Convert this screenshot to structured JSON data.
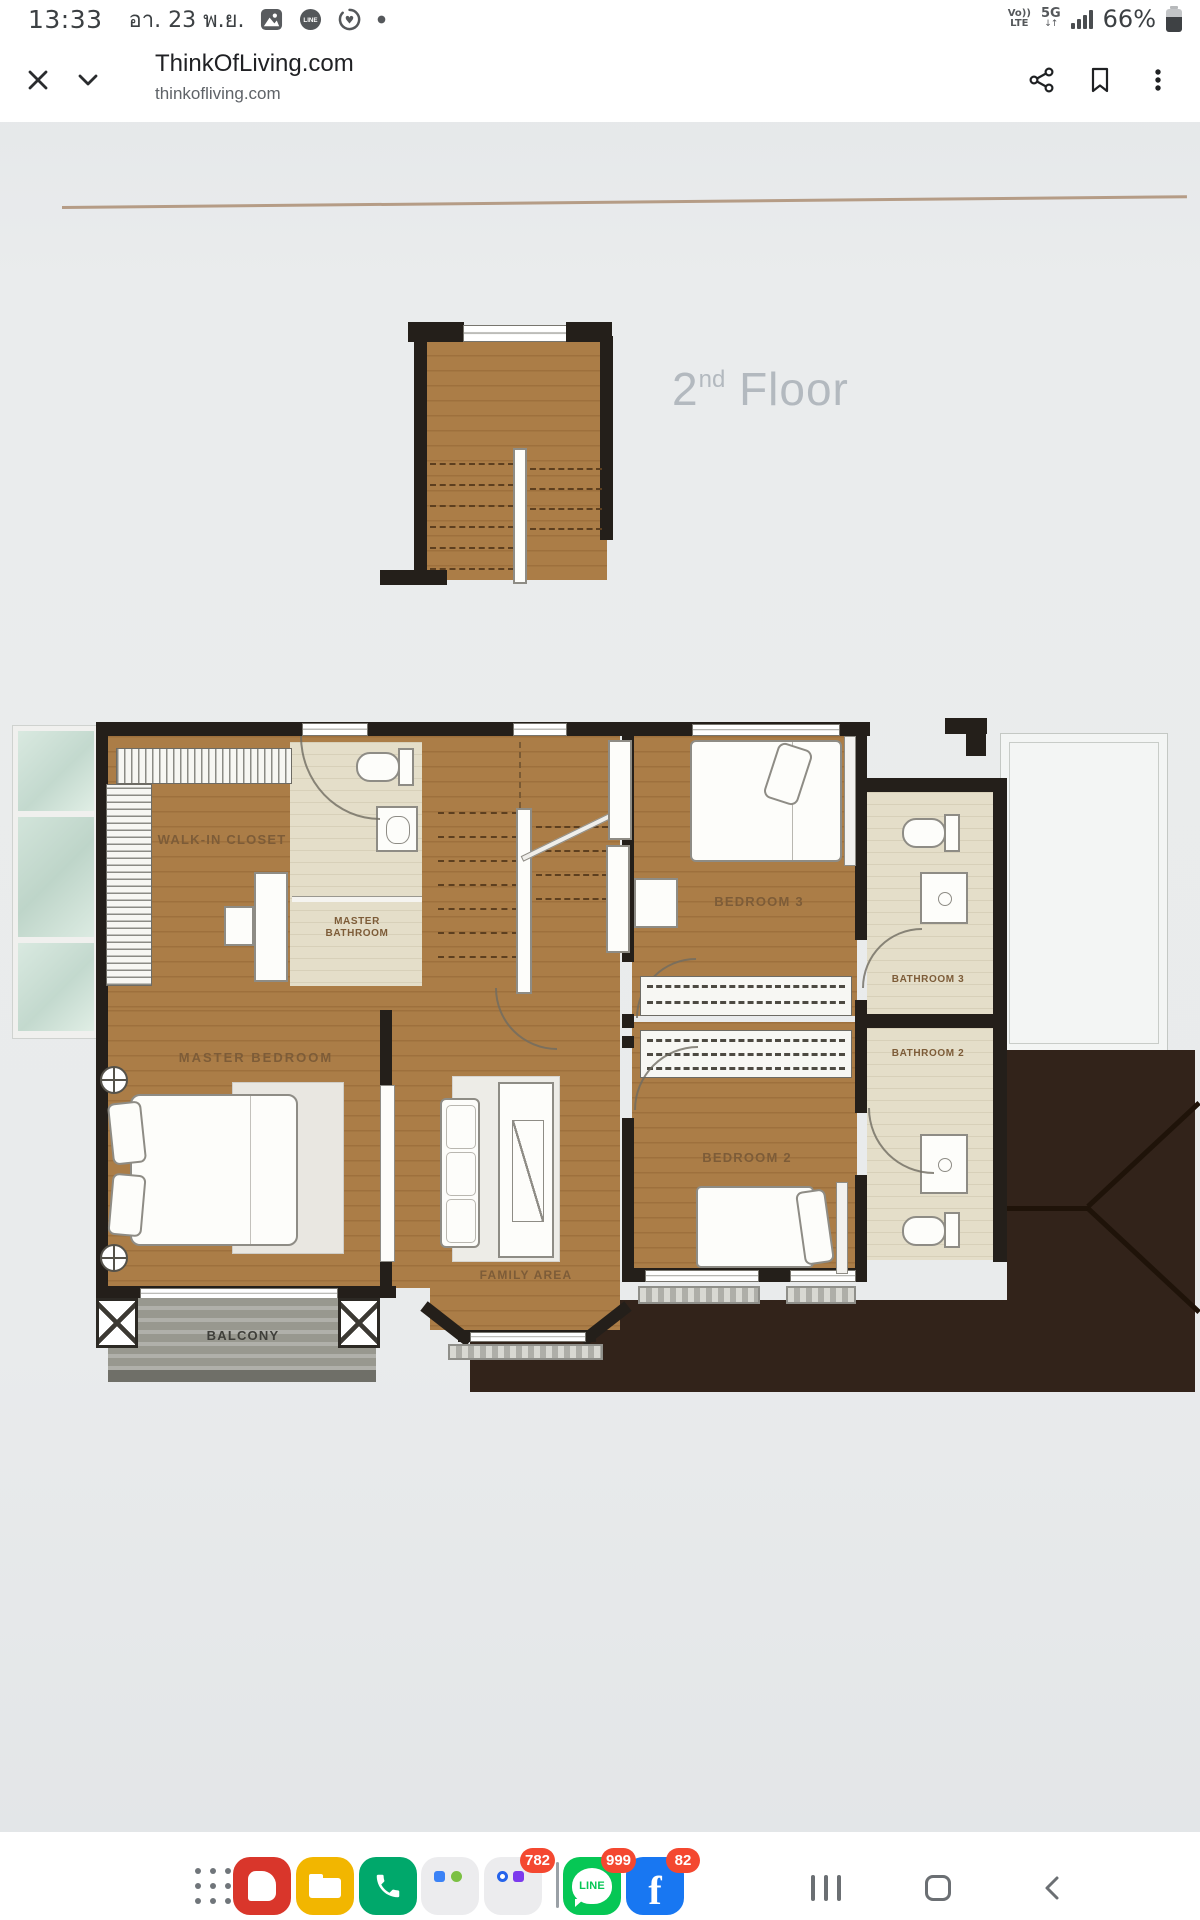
{
  "status_bar": {
    "time": "13:33",
    "date": "อา. 23 พ.ย.",
    "volte_top": "Vo))",
    "volte_bottom": "LTE",
    "network": "5G",
    "network_arrows": "↓↑",
    "battery_percent": "66%"
  },
  "browser": {
    "title": "ThinkOfLiving.com",
    "url": "thinkofliving.com"
  },
  "plan": {
    "floor_num": "2",
    "floor_sup": "nd",
    "floor_word": " Floor",
    "labels": {
      "walk_in_closet": "WALK-IN CLOSET",
      "master_bathroom_1": "MASTER",
      "master_bathroom_2": "BATHROOM",
      "master_bedroom": "MASTER BEDROOM",
      "bedroom_3": "BEDROOM 3",
      "bathroom_3": "BATHROOM 3",
      "bathroom_2": "BATHROOM 2",
      "bedroom_2": "BEDROOM 2",
      "family_area": "FAMILY AREA",
      "balcony": "BALCONY"
    }
  },
  "dock": {
    "line_text": "LINE",
    "facebook_letter": "f",
    "badge_folder": "782",
    "badge_line": "999",
    "badge_facebook": "82"
  },
  "colors": {
    "wood": "#ab7d47",
    "bath_beige": "#e4dec9",
    "roof_dark": "#32231a",
    "wall_black": "#241f1a",
    "glass_green": "#cde0d6",
    "label_brown": "#7d5c38",
    "badge_red": "#f44830",
    "line_green": "#06c755",
    "facebook_blue": "#1877f2",
    "phone_green": "#00a86b",
    "files_yellow": "#f2b600",
    "red_app": "#d9362b",
    "floor_title_gray": "#b3b9bf"
  }
}
